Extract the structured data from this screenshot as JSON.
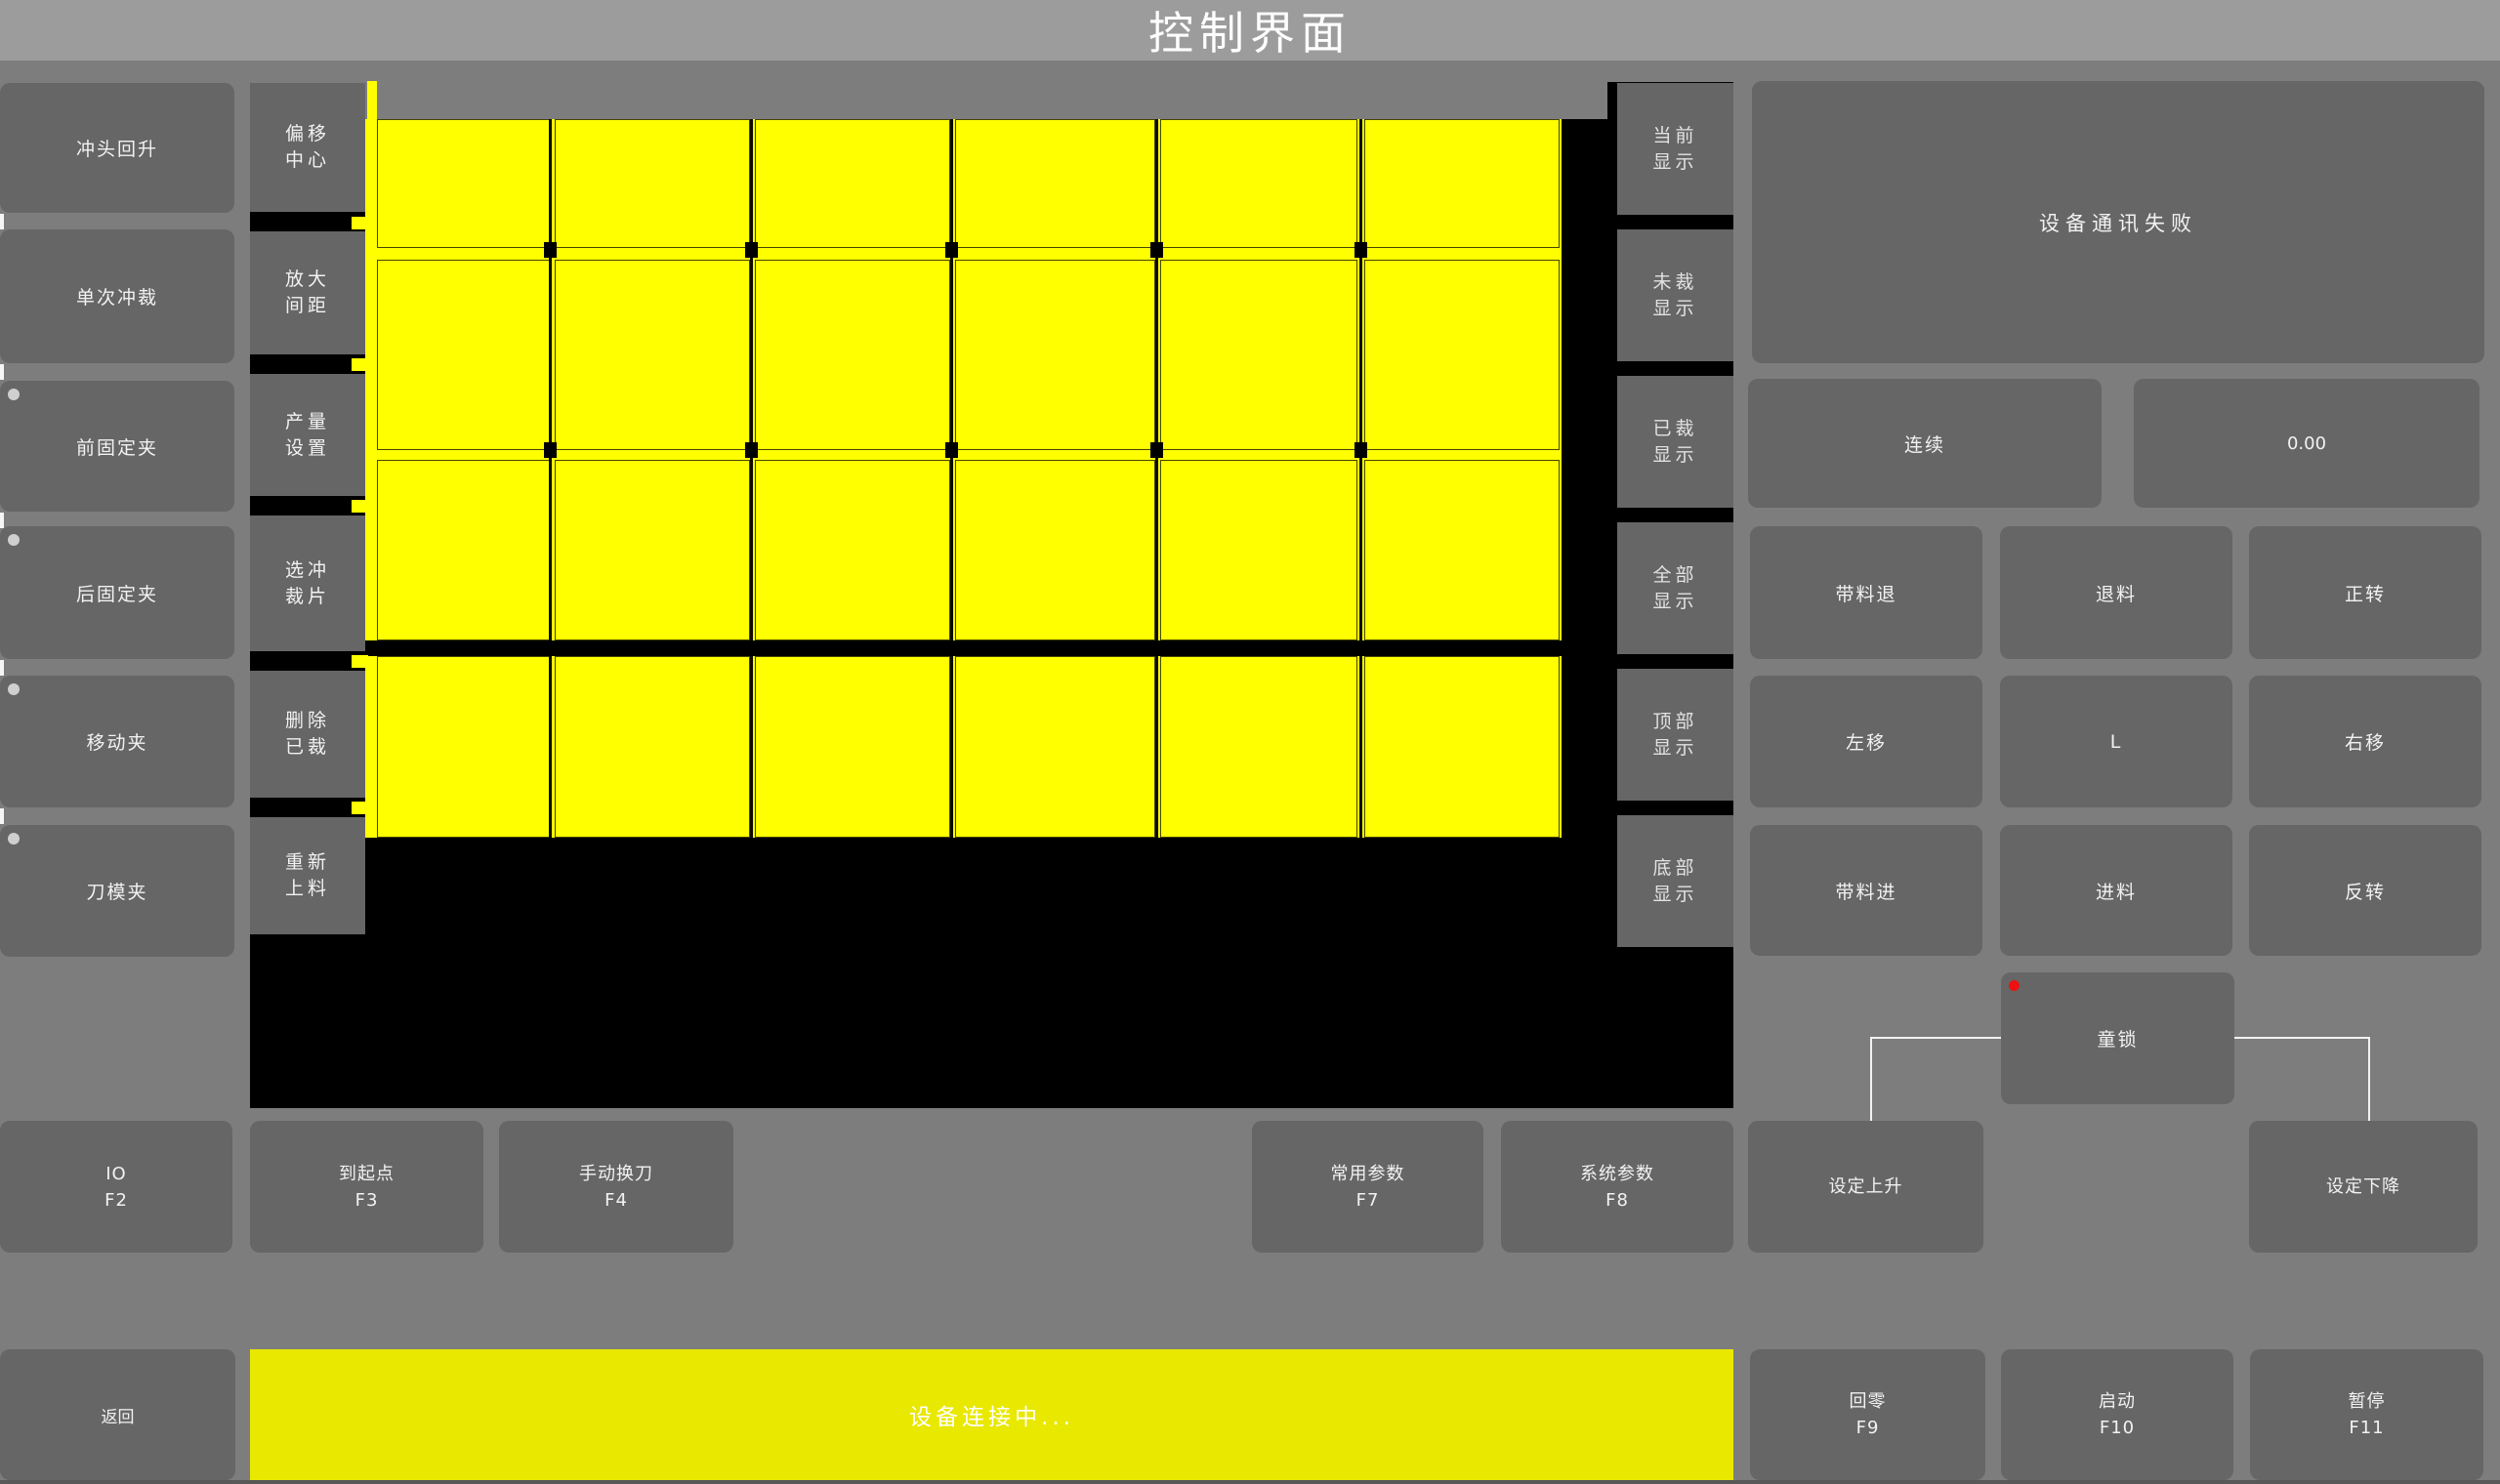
{
  "title_bar": {
    "title": "控制界面"
  },
  "left_panel": {
    "buttons": [
      {
        "label": "冲头回升",
        "indicator": false
      },
      {
        "label": "单次冲裁",
        "indicator": false
      },
      {
        "label": "前固定夹",
        "indicator": true
      },
      {
        "label": "后固定夹",
        "indicator": true
      },
      {
        "label": "移动夹",
        "indicator": true
      },
      {
        "label": "刀模夹",
        "indicator": true
      }
    ]
  },
  "tool_panel": {
    "buttons": [
      {
        "line1": "偏移",
        "line2": "中心"
      },
      {
        "line1": "放大",
        "line2": "间距"
      },
      {
        "line1": "产量",
        "line2": "设置"
      },
      {
        "line1": "选冲",
        "line2": "裁片"
      },
      {
        "line1": "删除",
        "line2": "已裁"
      },
      {
        "line1": "重新",
        "line2": "上料"
      }
    ]
  },
  "display_panel": {
    "buttons": [
      {
        "line1": "当前",
        "line2": "显示"
      },
      {
        "line1": "未裁",
        "line2": "显示"
      },
      {
        "line1": "已裁",
        "line2": "显示"
      },
      {
        "line1": "全部",
        "line2": "显示"
      },
      {
        "line1": "顶部",
        "line2": "显示"
      },
      {
        "line1": "底部",
        "line2": "显示"
      }
    ]
  },
  "status_panel": {
    "message": "设备通讯失败"
  },
  "mode_row": {
    "mode": "连续",
    "value": "0.00"
  },
  "jog_grid": {
    "rows": [
      [
        "带料退",
        "退料",
        "正转"
      ],
      [
        "左移",
        "L",
        "右移"
      ],
      [
        "带料进",
        "进料",
        "反转"
      ]
    ]
  },
  "child_lock": {
    "label": "童锁"
  },
  "function_keys": [
    {
      "label": "IO",
      "key": "F2"
    },
    {
      "label": "到起点",
      "key": "F3"
    },
    {
      "label": "手动换刀",
      "key": "F4"
    },
    {
      "label": "常用参数",
      "key": "F7"
    },
    {
      "label": "系统参数",
      "key": "F8"
    },
    {
      "label": "设定上升",
      "key": ""
    },
    {
      "label": "设定下降",
      "key": ""
    }
  ],
  "bottom_bar": {
    "back": "返回",
    "status": "设备连接中...",
    "keys": [
      {
        "label": "回零",
        "key": "F9"
      },
      {
        "label": "启动",
        "key": "F10"
      },
      {
        "label": "暂停",
        "key": "F11"
      }
    ]
  },
  "sheet_view": {
    "piece_columns": 6,
    "piece_rows": 4,
    "piece_color": "#ffff00",
    "background": "#000000"
  },
  "colors": {
    "sheet_yellow": "#ffff00",
    "status_bar_yellow": "#e8e800",
    "canvas_black": "#000000",
    "panel_gray": "#666666",
    "background_gray": "#7d7d7d",
    "title_bar_gray": "#9c9c9c",
    "alert_red": "#ee1111",
    "indicator_gray": "#cfcfcf",
    "connector_white": "#f2f2f2"
  }
}
